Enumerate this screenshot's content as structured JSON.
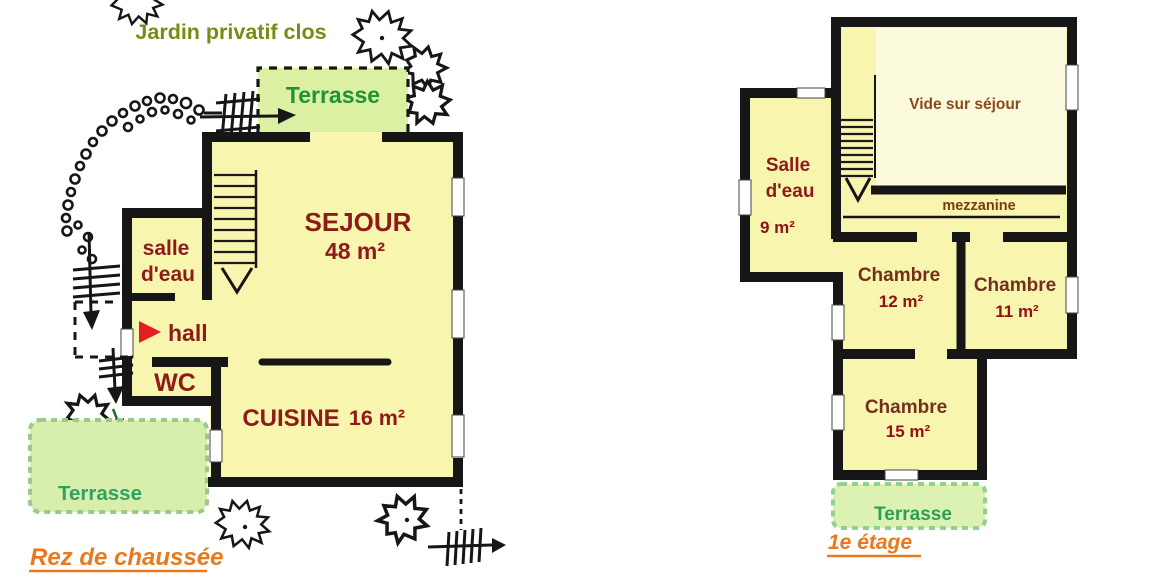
{
  "colors": {
    "floor": "#F8F5AF",
    "vide_floor": "#FCFADC",
    "terrace_top": "#DCF0A4",
    "terrace_ground": "#D8EEAD",
    "terrace_first": "#DBF2B3",
    "room_label": "#8E1A1A",
    "vide_label": "#8B4A1E",
    "mezzanine_label": "#7A3A12",
    "chambre_label": "#73301C",
    "area_label": "#8F1116",
    "garden_label": "#7C8A12",
    "terrace_label_top": "#1F9432",
    "terrace_label_ground": "#2FA261",
    "terrace_label_first": "#2E9E55",
    "floor_title": "#E8791C",
    "entry_arrow": "#E31E1E",
    "sprig": "#1B6B2D"
  },
  "ground_floor": {
    "title": "Rez de chaussée",
    "garden_label": "Jardin privatif clos",
    "terrace_top": "Terrasse",
    "terrace_side": "Terrasse",
    "sejour": "SEJOUR",
    "sejour_area": "48 m²",
    "salle_eau_1": "salle",
    "salle_eau_2": "d'eau",
    "hall": "hall",
    "wc": "WC",
    "cuisine": "CUISINE",
    "cuisine_area": "16 m²"
  },
  "first_floor": {
    "title": "1e étage",
    "terrace": "Terrasse",
    "vide": "Vide sur séjour",
    "mezzanine": "mezzanine",
    "salle_eau_1": "Salle",
    "salle_eau_2": "d'eau",
    "salle_eau_area": "9 m²",
    "chambre_a": "Chambre",
    "chambre_a_area": "12 m²",
    "chambre_b": "Chambre",
    "chambre_b_area": "11 m²",
    "chambre_c": "Chambre",
    "chambre_c_area": "15 m²"
  }
}
